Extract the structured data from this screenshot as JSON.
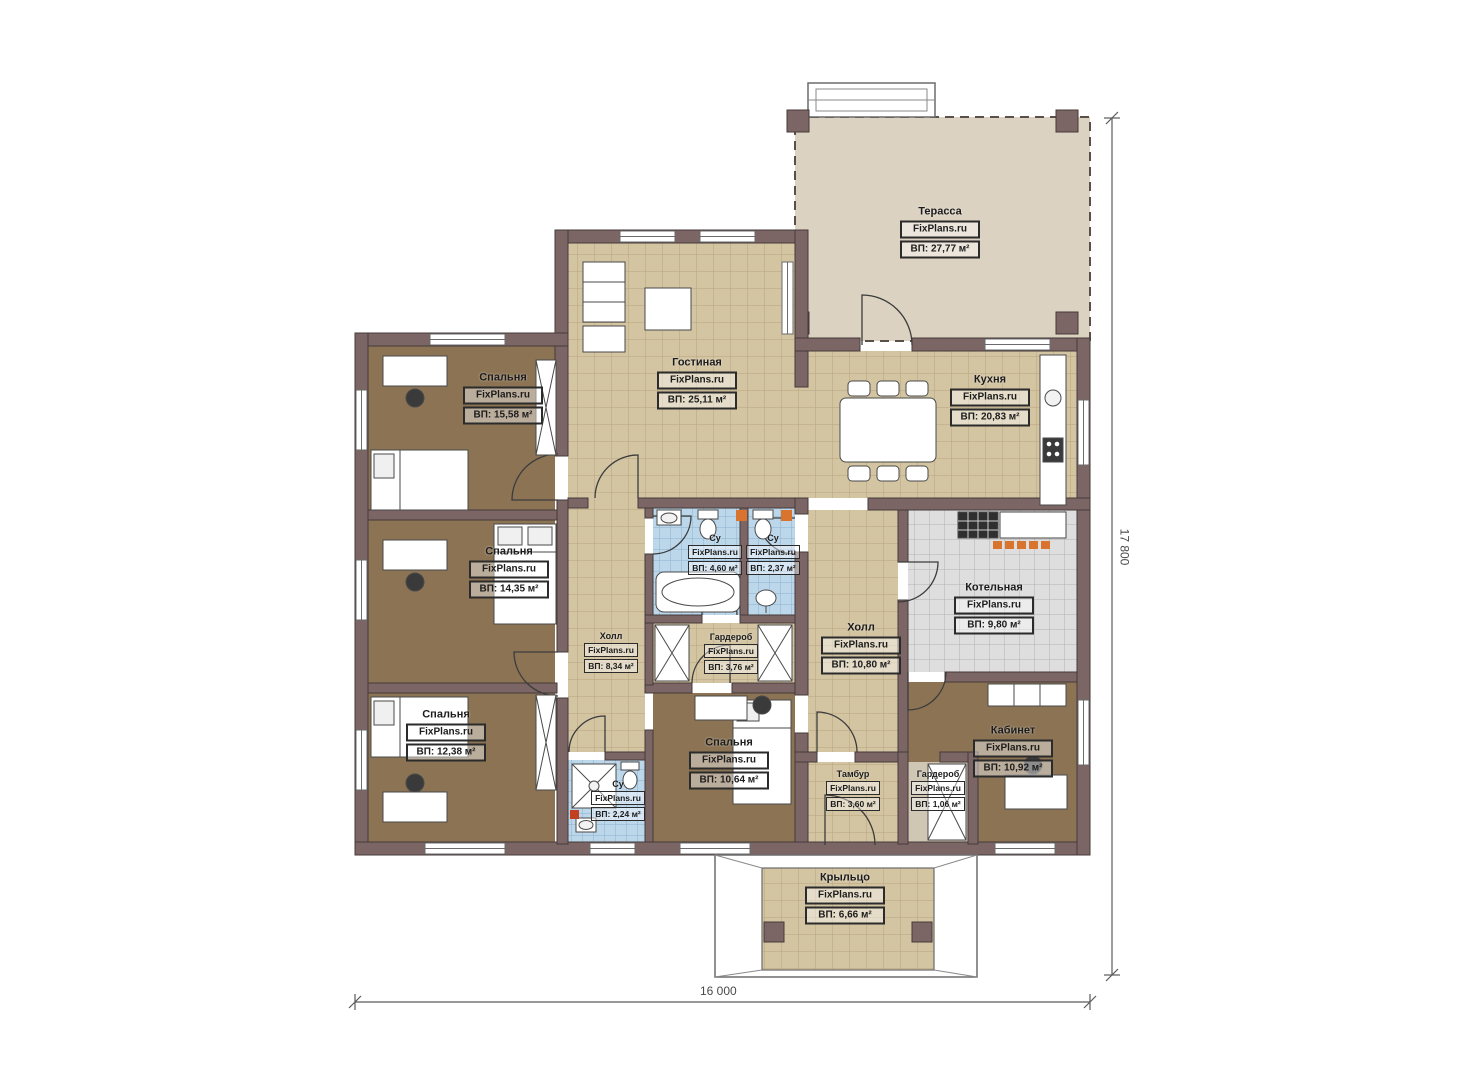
{
  "watermark": "FixPlans.ru",
  "dimensions": {
    "bottom": "16 000",
    "right": "17 800"
  },
  "rooms": [
    {
      "name": "Терасса",
      "brand": "FixPlans.ru",
      "area": "ВП: 27,77 м²"
    },
    {
      "name": "Гостиная",
      "brand": "FixPlans.ru",
      "area": "ВП: 25,11 м²"
    },
    {
      "name": "Кухня",
      "brand": "FixPlans.ru",
      "area": "ВП: 20,83 м²"
    },
    {
      "name": "Спальня",
      "brand": "FixPlans.ru",
      "area": "ВП: 15,58 м²"
    },
    {
      "name": "Спальня",
      "brand": "FixPlans.ru",
      "area": "ВП: 14,35 м²"
    },
    {
      "name": "Спальня",
      "brand": "FixPlans.ru",
      "area": "ВП: 12,38 м²"
    },
    {
      "name": "Холл",
      "brand": "FixPlans.ru",
      "area": "ВП: 8,34 м²"
    },
    {
      "name": "Гардероб",
      "brand": "FixPlans.ru",
      "area": "ВП: 3,76 м²"
    },
    {
      "name": "Холл",
      "brand": "FixPlans.ru",
      "area": "ВП: 10,80 м²"
    },
    {
      "name": "Котельная",
      "brand": "FixPlans.ru",
      "area": "ВП: 9,80 м²"
    },
    {
      "name": "Кабинет",
      "brand": "FixPlans.ru",
      "area": "ВП: 10,92 м²"
    },
    {
      "name": "Спальня",
      "brand": "FixPlans.ru",
      "area": "ВП: 10,64 м²"
    },
    {
      "name": "Тамбур",
      "brand": "FixPlans.ru",
      "area": "ВП: 3,60 м²"
    },
    {
      "name": "Гардероб",
      "brand": "FixPlans.ru",
      "area": "ВП: 1,06 м²"
    },
    {
      "name": "Су",
      "brand": "FixPlans.ru",
      "area": "ВП: 4,60 м²"
    },
    {
      "name": "Су",
      "brand": "FixPlans.ru",
      "area": "ВП: 2,37 м²"
    },
    {
      "name": "Су",
      "brand": "FixPlans.ru",
      "area": "ВП: 2,24 м²"
    },
    {
      "name": "Крыльцо",
      "brand": "FixPlans.ru",
      "area": "ВП: 6,66 м²"
    }
  ],
  "colors": {
    "wall": "#7b6665",
    "tile_beige": "#d3c4a2",
    "tile_blue": "#bcd6ea",
    "tile_gray": "#dedede",
    "carpet": "#8b7354",
    "terrace": "#dcd2c1",
    "accent_orange": "#d9742f"
  }
}
